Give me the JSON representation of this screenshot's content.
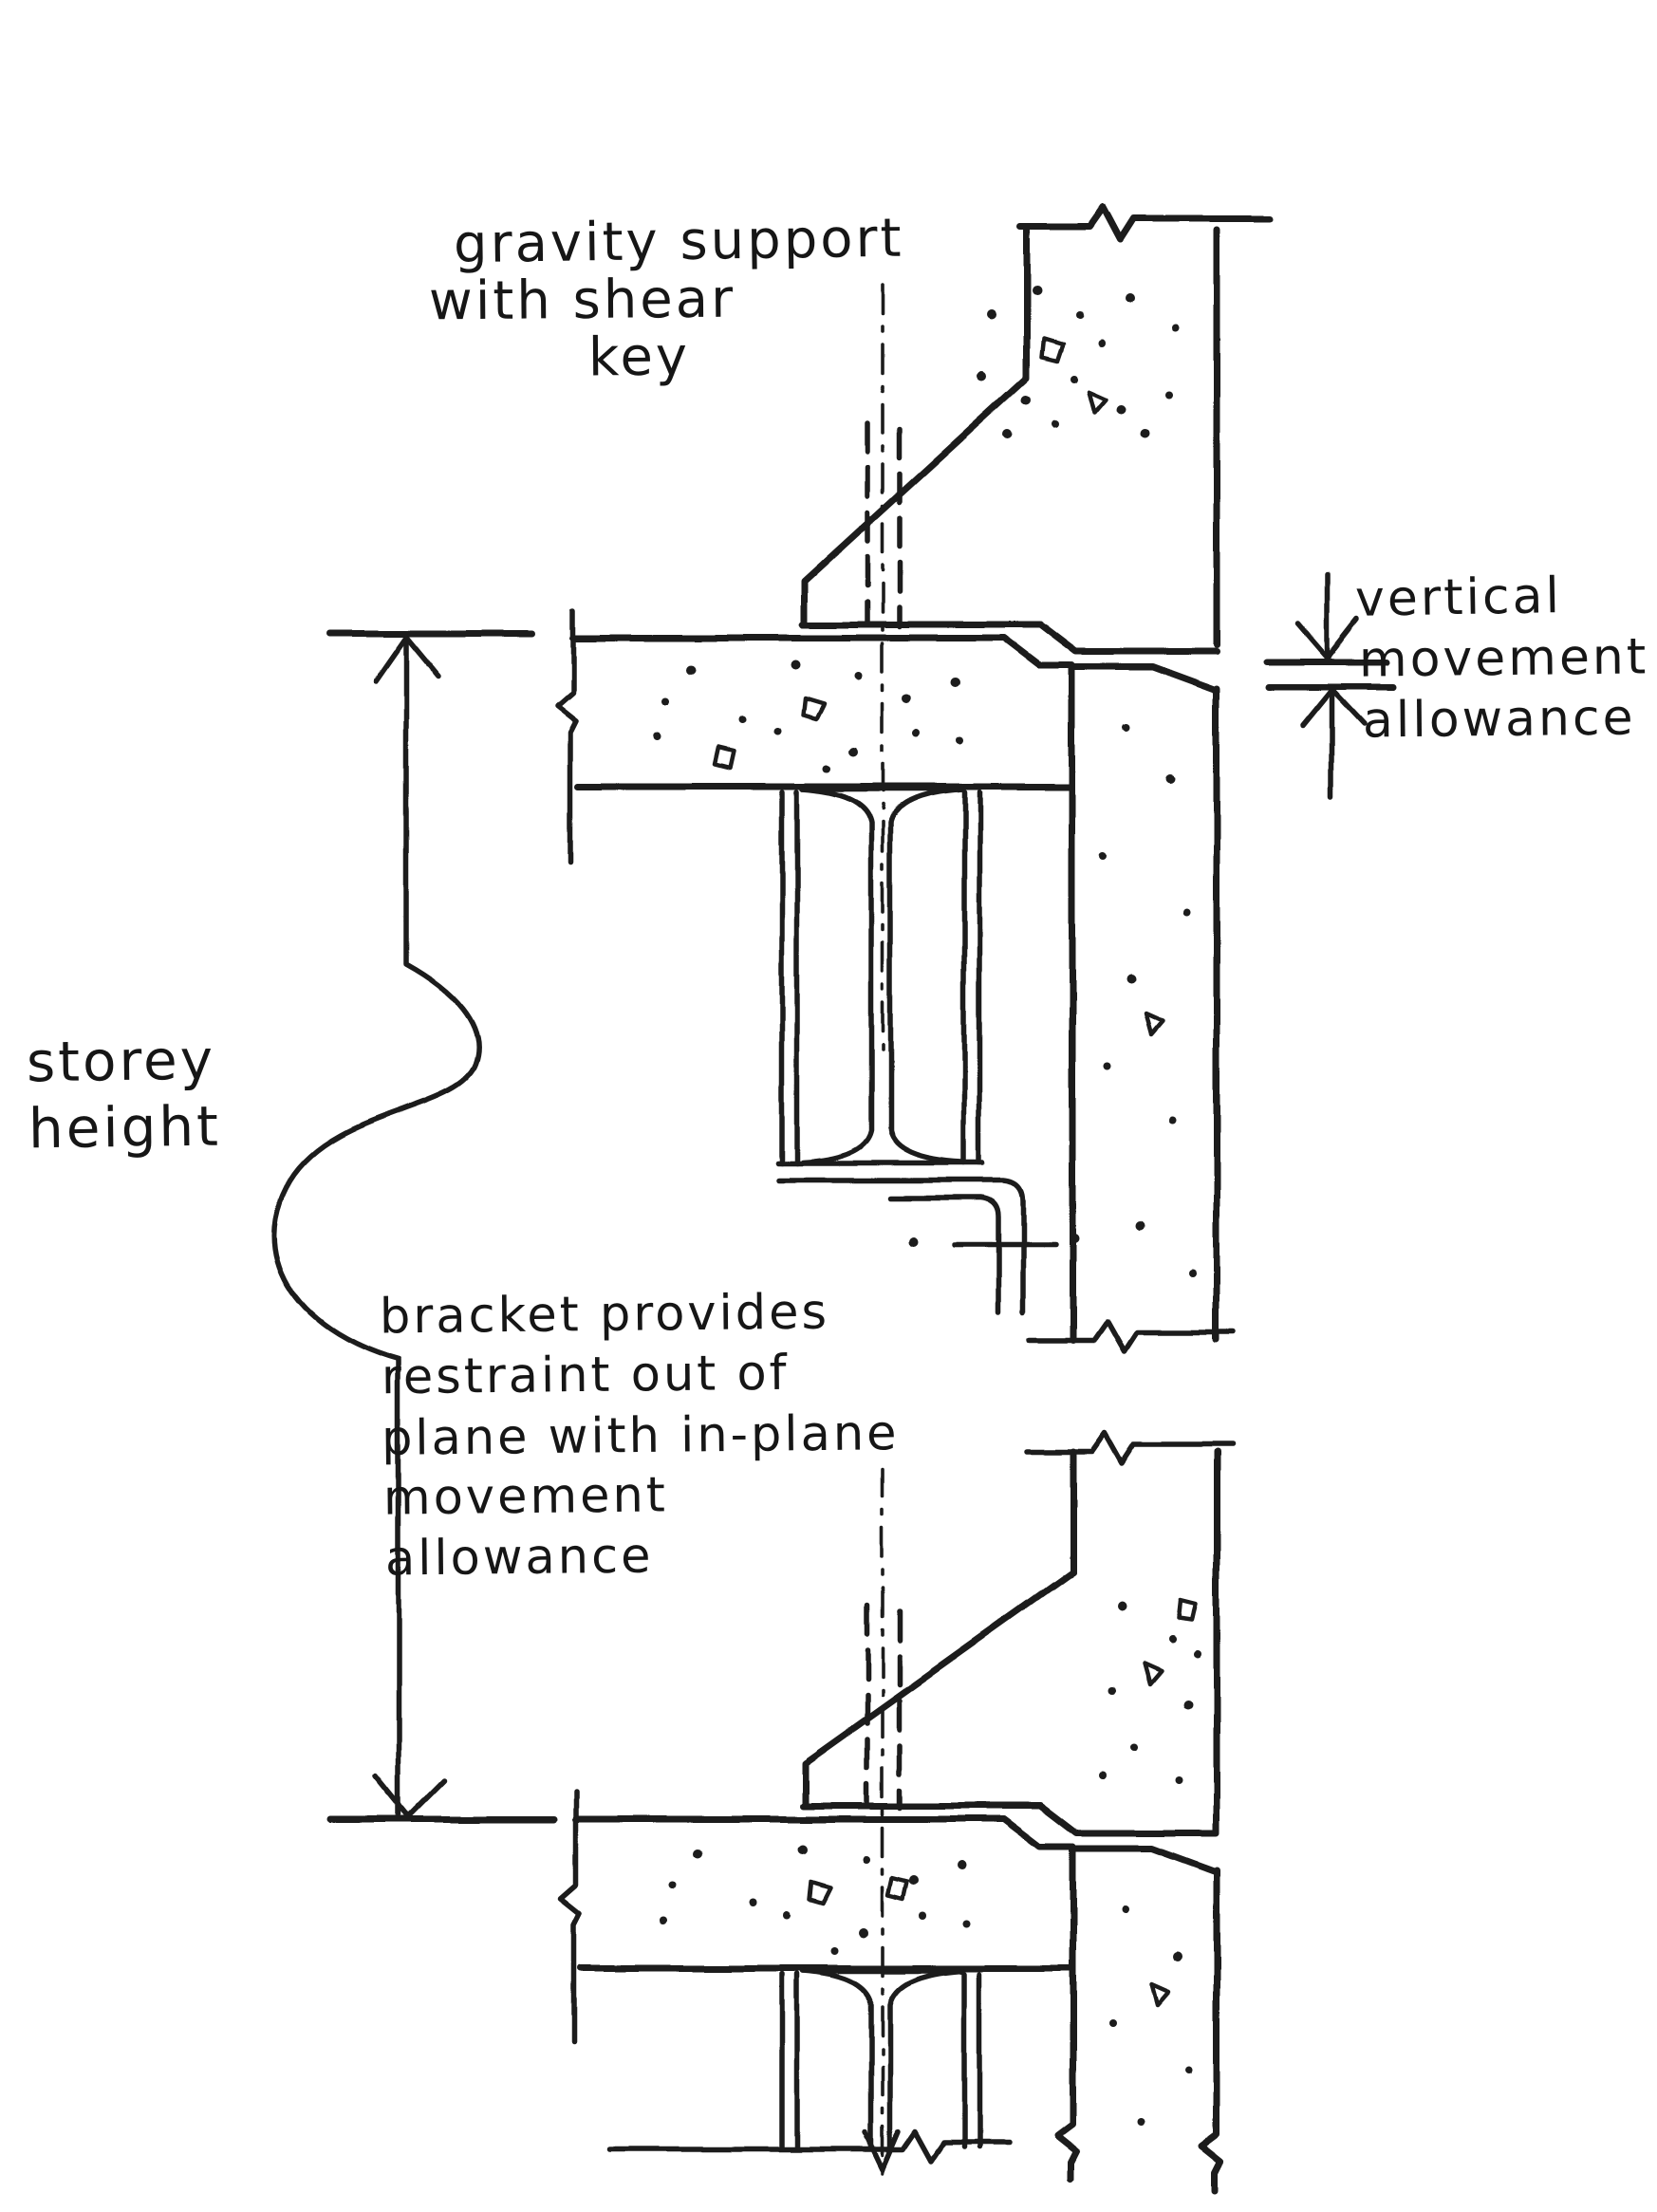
{
  "page": {
    "background_color": "#ffffff",
    "ink_color": "#1b1b1b",
    "figure_type": "hand-drawn building section sketch"
  },
  "annotations": {
    "gravity_support": {
      "lines": [
        "gravity support",
        "with shear",
        "key"
      ]
    },
    "vertical_movement": {
      "lines": [
        "vertical",
        "movement",
        "allowance"
      ]
    },
    "storey_height": {
      "lines": [
        "storey",
        "height"
      ]
    },
    "bracket_note": {
      "lines": [
        "bracket provides",
        "restraint out of",
        "plane with in-plane",
        "movement",
        "allowance"
      ]
    }
  }
}
